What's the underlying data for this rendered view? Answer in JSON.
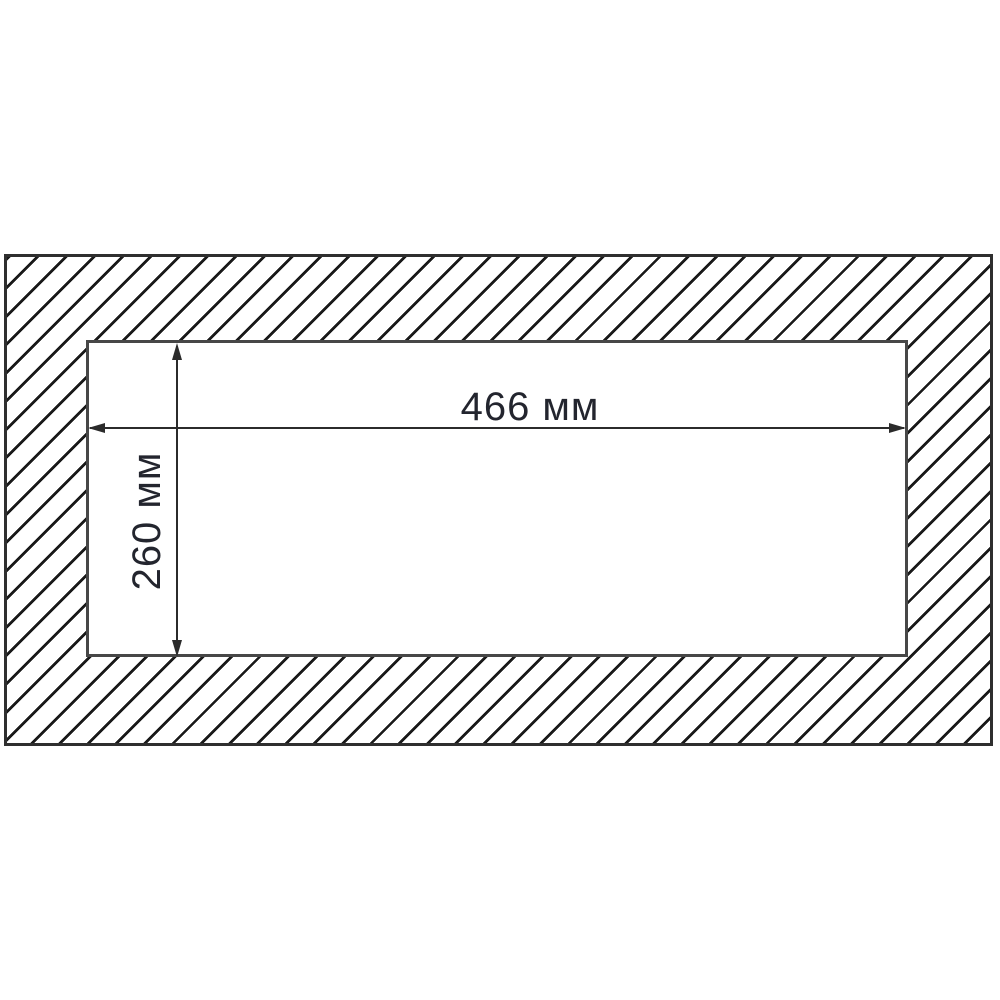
{
  "diagram": {
    "type": "installation-cutout-drawing",
    "width_dimension": {
      "label": "466 мм",
      "value_mm": 466
    },
    "height_dimension": {
      "label": "260 мм",
      "value_mm": 260
    },
    "colors": {
      "background": "#ffffff",
      "hatch": "#191919",
      "panel_border": "#2f2f2f",
      "hole_border": "#474747",
      "dimension": "#2b2b2b",
      "text": "#23252e"
    }
  }
}
